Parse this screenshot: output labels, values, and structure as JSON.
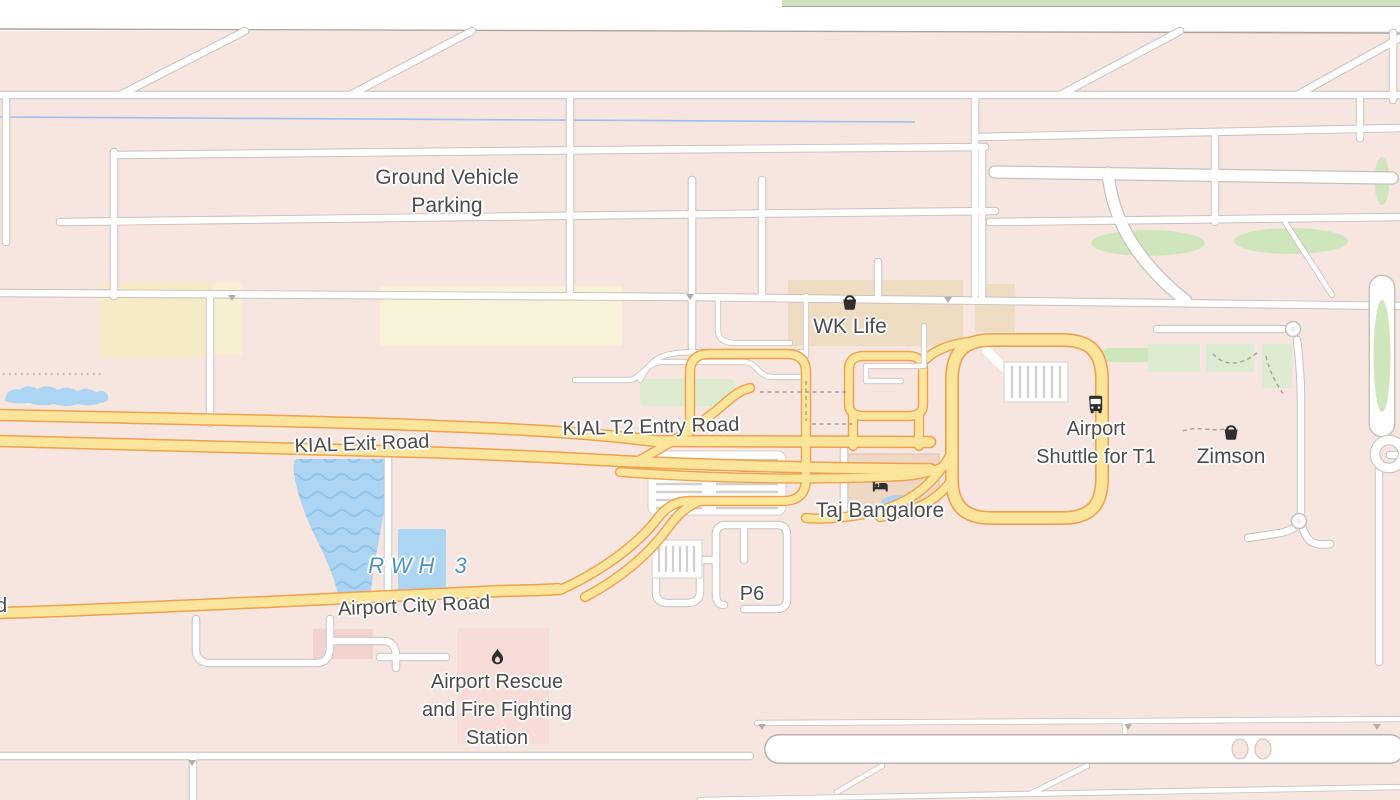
{
  "map": {
    "labels": {
      "ground_vehicle_parking": {
        "line1": "Ground Vehicle",
        "line2": "Parking"
      },
      "wk_life": {
        "text": "WK Life",
        "icon": "shopping-basket"
      },
      "kial_t2_entry_road": {
        "text": "KIAL T2 Entry Road"
      },
      "kial_exit_road": {
        "text": "KIAL Exit Road"
      },
      "airport_shuttle_t1": {
        "line1": "Airport",
        "line2": "Shuttle for T1",
        "icon": "bus"
      },
      "zimson": {
        "text": "Zimson",
        "icon": "shopping-basket"
      },
      "taj_bangalore": {
        "text": "Taj Bangalore",
        "icon": "hotel-bed"
      },
      "rwh_3": {
        "text": "RWH 3"
      },
      "airport_city_road": {
        "text": "Airport City Road"
      },
      "p6": {
        "text": "P6"
      },
      "fire_station": {
        "line1": "Airport Rescue",
        "line2": "and Fire Fighting",
        "line3": "Station",
        "icon": "fire-flame"
      },
      "clipped_road_label": {
        "text": "d"
      }
    },
    "colors": {
      "background": "#f7e5e0",
      "minor_road": "#ffffff",
      "minor_road_casing": "#c7c1bc",
      "major_road": "#fbe59b",
      "major_road_casing": "#efa14f",
      "water": "#abd5f2",
      "water_label": "#4d94c9",
      "grass": "#cfe6bd",
      "building": "#eedcc2",
      "label_text": "#4c4c4c",
      "poi_icon": "#2e2e2e"
    }
  }
}
